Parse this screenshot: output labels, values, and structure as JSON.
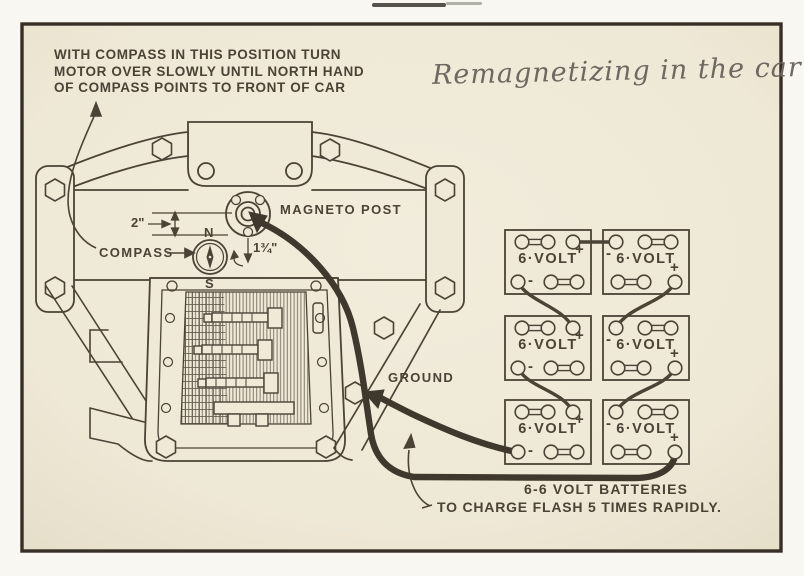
{
  "title": {
    "text": "Remagnetizing in the car"
  },
  "instruction": {
    "text": "WITH COMPASS IN THIS POSITION TURN\nMOTOR OVER SLOWLY UNTIL NORTH HAND\nOF COMPASS POINTS TO FRONT OF CAR"
  },
  "labels": {
    "magneto_post": "MAGNETO POST",
    "compass": "COMPASS",
    "ground": "GROUND",
    "north": "N",
    "south": "S",
    "dim_two_inch": "2\"",
    "dim_one_three_quarter": "1¾\""
  },
  "batteries": {
    "plus_sign": "+",
    "minus_sign": "-",
    "caption": "6-6 VOLT BATTERIES",
    "charge_note": "TO CHARGE FLASH 5 TIMES RAPIDLY.",
    "items": [
      {
        "label": "6·VOLT"
      },
      {
        "label": "6·VOLT"
      },
      {
        "label": "6·VOLT"
      },
      {
        "label": "6·VOLT"
      },
      {
        "label": "6·VOLT"
      },
      {
        "label": "6·VOLT"
      }
    ]
  },
  "colors": {
    "paper": "#efe9d8",
    "ink": "#4a4336",
    "frame": "#352f26",
    "title_gray": "#6e6860"
  }
}
